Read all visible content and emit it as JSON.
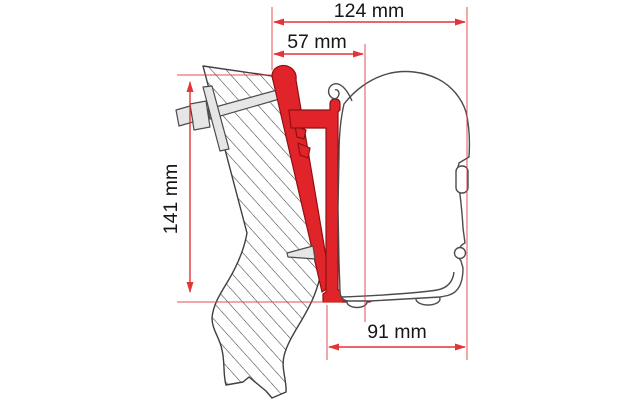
{
  "diagram": {
    "type": "technical-drawing",
    "subject": "Awning wall-mount adapter bracket cross-section",
    "unit": "mm",
    "dimensions": {
      "overall_depth": {
        "label": "124 mm",
        "value": 124
      },
      "bracket_offset": {
        "label": "57 mm",
        "value": 57
      },
      "bracket_height": {
        "label": "141 mm",
        "value": 141
      },
      "case_depth": {
        "label": "91 mm",
        "value": 91
      }
    },
    "parts": {
      "wall": "vehicle wall (hatched section)",
      "adapter": "red adapter bracket profile",
      "awning": "awning case outline",
      "bolts": "through-bolts with backing plate"
    },
    "colors": {
      "dimension_red": "#e23538",
      "adapter_fill": "#e1242a",
      "adapter_stroke": "#8e1013",
      "outline_gray": "#4c4c4c",
      "background": "#ffffff"
    }
  }
}
